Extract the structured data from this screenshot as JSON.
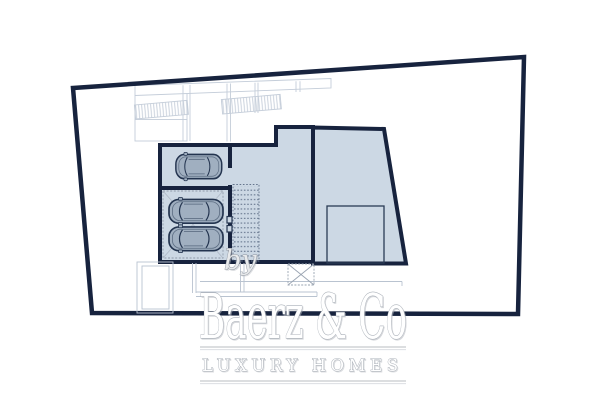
{
  "document": {
    "kind": "architectural-floor-plan",
    "level_shown": "garage level with parking, stairs and storage rooms"
  },
  "watermark": {
    "by_label": "by",
    "brand_name": "Baerz & Co",
    "tagline": "LUXURY HOMES"
  },
  "plan": {
    "car_count": 3,
    "features": [
      "site-boundary",
      "garage-stall-top",
      "garage-stall-lower",
      "car-lift-platform",
      "staircase",
      "hall-room",
      "right-room",
      "storage-area",
      "exterior-stairs",
      "exterior-path"
    ]
  },
  "colors": {
    "wall_navy": "#17233e",
    "room_fill": "#ccd8e4",
    "car_fill": "#a0afc0",
    "stair_dot": "#64748c",
    "faint_line": "#c4cdd9",
    "watermark_gray": "#aab0b8"
  }
}
